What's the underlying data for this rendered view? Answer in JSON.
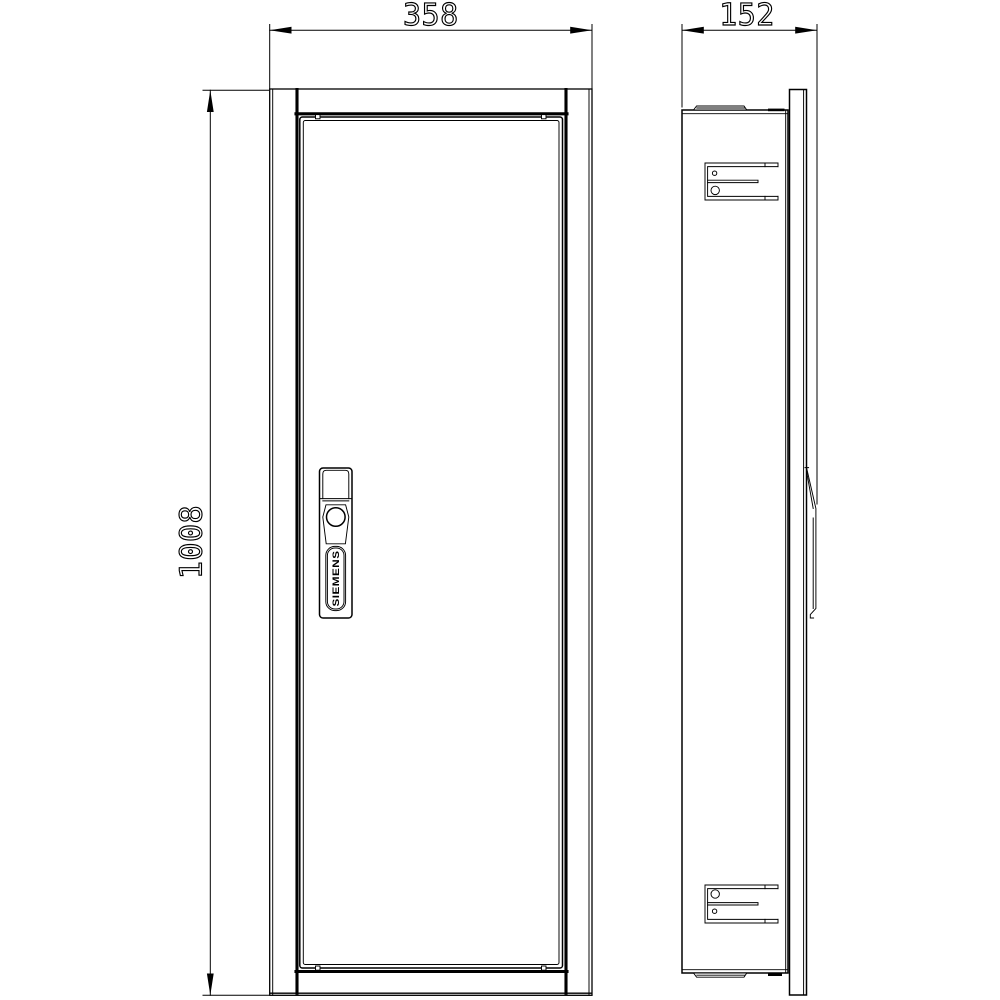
{
  "canvas": {
    "background": "#ffffff",
    "line_color": "#000000"
  },
  "dimensions": {
    "width_mm": "358",
    "depth_mm": "152",
    "height_mm": "1008"
  },
  "views": {
    "front": {
      "handle_brand": "SIEMENS"
    }
  }
}
